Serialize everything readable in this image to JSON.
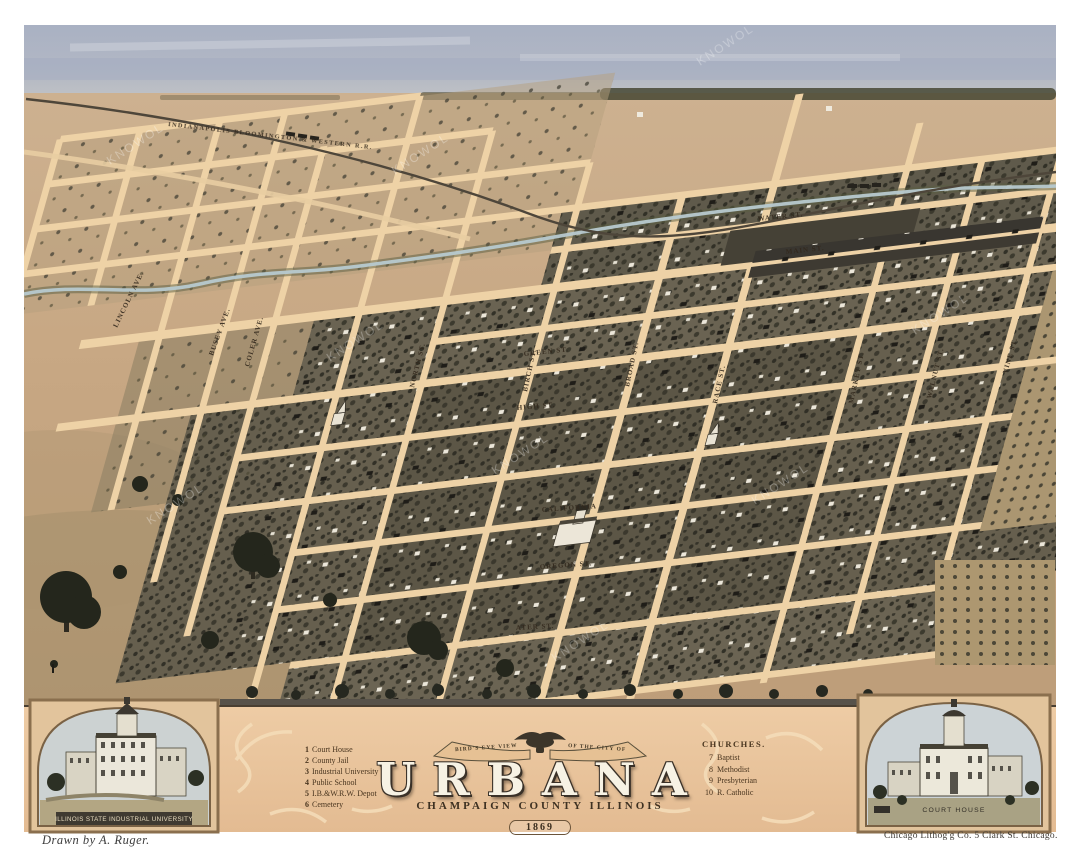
{
  "artwork": {
    "banner_left": "BIRD'S EYE VIEW",
    "banner_right": "OF THE CITY OF",
    "title": "URBANA",
    "subtitle": "CHAMPAIGN COUNTY ILLINOIS",
    "year": "1869"
  },
  "legend": {
    "items": [
      {
        "num": "1",
        "label": "Court House"
      },
      {
        "num": "2",
        "label": "County Jail"
      },
      {
        "num": "3",
        "label": "Industrial University"
      },
      {
        "num": "4",
        "label": "Public School"
      },
      {
        "num": "5",
        "label": "I.B.&W.R.W. Depot"
      },
      {
        "num": "6",
        "label": "Cemetery"
      }
    ]
  },
  "churches": {
    "heading": "CHURCHES.",
    "items": [
      {
        "num": "7",
        "label": "Baptist"
      },
      {
        "num": "8",
        "label": "Methodist"
      },
      {
        "num": "9",
        "label": "Presbyterian"
      },
      {
        "num": "10",
        "label": "R. Catholic"
      }
    ]
  },
  "insets": {
    "left_caption": "ILLINOIS STATE INDUSTRIAL UNIVERSITY",
    "right_caption": "COURT HOUSE"
  },
  "credits": {
    "artist": "Drawn by A. Ruger.",
    "printer": "Chicago Lithog'g Co. 5 Clark St. Chicago."
  },
  "map": {
    "railroad": "INDIANAPOLIS BLOOMINGTON & WESTERN R.R.",
    "streets_ns": [
      "LINCOLN AVE.",
      "BUSEY AVE.",
      "COLER AVE.",
      "NORTH ST.",
      "BIRCH ST.",
      "BROAD ST.",
      "RACE ST.",
      "MARKET ST.",
      "WALNUT ST.",
      "VINE ST."
    ],
    "streets_ew": [
      "WATER ST.",
      "MAIN ST.",
      "GREEN ST.",
      "HIGH ST.",
      "CALIFORNIA",
      "OREGON ST.",
      "ATER ST."
    ]
  },
  "watermark": "KNOWOL",
  "colors": {
    "paper": "#ffffff",
    "sky": "#aeb6c6",
    "ground": "#c9aa85",
    "road": "#eed2a6",
    "block": "#665f4e",
    "panel": "#ecc9a2",
    "ink": "#3a3126"
  }
}
